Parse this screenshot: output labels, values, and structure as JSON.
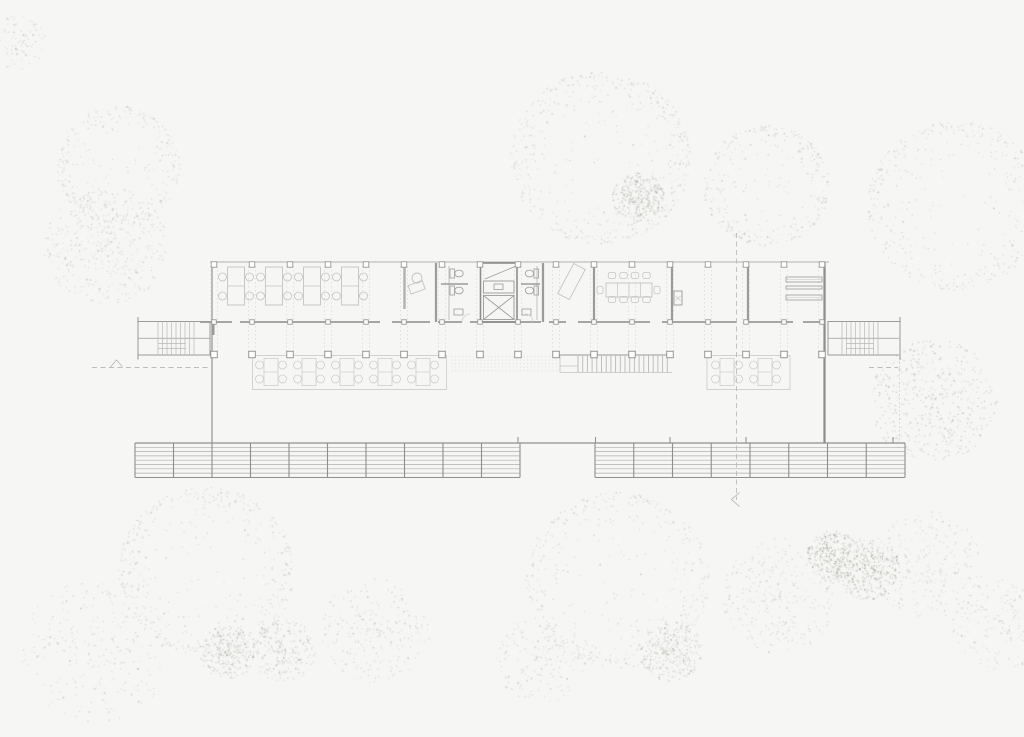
{
  "meta": {
    "width": 1024,
    "height": 737,
    "description": "Architectural ground floor plan drawing of an elongated pavilion building surrounded by stippled trees; no visible text or labels"
  },
  "colors": {
    "background": "#f6f6f4",
    "slab_line": "#b2b2b0",
    "wall": "#9b9b99",
    "wall_dark": "#8d8d8b",
    "furniture": "#c3c3c1",
    "furniture_light": "#cfcfcd",
    "grid_dash": "#d6d6d4",
    "tread": "#b9b9b7",
    "band_line": "#aeaeac",
    "band_edge": "#8f8f8d",
    "section": "#bcbcba",
    "column_fill": "#ffffff",
    "dot_light": "#b9b7b4",
    "dot_mid": "#a9a7a3",
    "dot_dark": "#999791"
  },
  "plan": {
    "grid": {
      "x_start": 214,
      "spacing": 38,
      "count": 17,
      "top_y": 263,
      "wall_y": 322,
      "colonnade_y": 354.5,
      "dash_y1": 266,
      "dash_y2": 352
    },
    "slab": {
      "x1": 210,
      "x2": 829,
      "y": 262
    },
    "left_wall": {
      "x": 212,
      "y1": 262.5,
      "y2": 443
    },
    "right_wall": {
      "x": 824.5,
      "y1": 262.5,
      "y2": 443
    },
    "wall_stub": {
      "x": 213.5,
      "y1": 322,
      "y2": 335
    },
    "wall_segments": [
      [
        200,
        232
      ],
      [
        240,
        380
      ],
      [
        392,
        430
      ],
      [
        438,
        462
      ],
      [
        470,
        541
      ],
      [
        549,
        566
      ],
      [
        578,
        650
      ],
      [
        662,
        737
      ],
      [
        749,
        793
      ],
      [
        803,
        825
      ]
    ],
    "interior_walls": [
      436,
      543,
      594,
      672,
      748
    ],
    "partition": {
      "x": 404.5,
      "y1": 263,
      "y2": 309
    },
    "office_desks": {
      "centers": [
        236,
        274,
        312,
        350
      ],
      "top": 267,
      "w": 17,
      "h": 38,
      "chair_r": 4,
      "chair_dx": 13.5,
      "chair_dy": [
        10,
        29
      ]
    },
    "reception": {
      "chair": {
        "cx": 417,
        "cy": 278,
        "r": 5
      },
      "desk": {
        "x": 409,
        "y": 283,
        "w": 15,
        "h": 9,
        "rot": -20
      }
    },
    "bath_left": {
      "plumb_x": 449,
      "stall": [
        441,
        468,
        284
      ],
      "toilets": [
        [
          450,
          269
        ],
        [
          450,
          286
        ]
      ],
      "sink": [
        454,
        309,
        9,
        6
      ],
      "door": "M 462 322 A 8 8 0 0 1 470 314"
    },
    "bath_right": {
      "plumb_x": 537,
      "stall": [
        521,
        540,
        284
      ],
      "toilets": [
        [
          534,
          269
        ],
        [
          534,
          286
        ]
      ],
      "sink": [
        522,
        309,
        9,
        6
      ],
      "door": "M 533 322 A 8 8 0 0 0 525 314"
    },
    "elevator": {
      "x": 480.5,
      "y": 263,
      "w": 36.5,
      "h": 59,
      "machine": [
        483.5,
        281,
        30.5,
        12
      ],
      "inner": [
        494,
        284,
        9,
        5.5
      ],
      "shaft": [
        483.5,
        295.5,
        30.5,
        24
      ],
      "diag": [
        485,
        279,
        515,
        266.5
      ]
    },
    "lounge": {
      "cx": 571.5,
      "cy": 281.5,
      "w": 13,
      "h": 34,
      "rot": 28
    },
    "meeting": {
      "x": 606,
      "y": 283,
      "w": 46,
      "h": 14,
      "dividers": [
        617.5,
        629,
        640.5
      ],
      "chair_cx": [
        612,
        623.5,
        635,
        646.5
      ],
      "top_y": 275.5,
      "bot_y": 299.5,
      "ends": [
        [
          600,
          290
        ],
        [
          657,
          290
        ]
      ],
      "chair_w": 7.5,
      "chair_h": 6
    },
    "cabinet": {
      "x": 674,
      "y": 291,
      "w": 8,
      "h": 14
    },
    "shelves": {
      "x": 786,
      "w": 36,
      "rows": [
        [
          277,
          5
        ],
        [
          286,
          3
        ],
        [
          295,
          5
        ]
      ]
    },
    "stairs": [
      {
        "x": 138,
        "y": 321.5,
        "w": 72,
        "h": 33.5,
        "tx1": 158,
        "tx2": 198,
        "tick_x": 138,
        "land_x1": 158
      },
      {
        "x": 828,
        "y": 321.5,
        "w": 72,
        "h": 33.5,
        "tx1": 842,
        "tx2": 882,
        "tick_x": 900,
        "land_x1": 846
      }
    ],
    "terraces": [
      {
        "x": 252.5,
        "y": 355.5,
        "w": 194,
        "h": 34,
        "clusters": [
          271,
          309,
          347,
          385,
          423
        ]
      },
      {
        "x": 707,
        "y": 355.5,
        "w": 83,
        "h": 34,
        "clusters": [
          727,
          765
        ]
      }
    ],
    "hatch": {
      "x": 452,
      "y": 356,
      "w": 106,
      "h": 17,
      "step": 3.6
    },
    "center_steps": {
      "x1": 578,
      "x2": 672,
      "y1": 355,
      "y2": 372.5,
      "step": 4.7,
      "top_x1": 556,
      "notch_x": 560,
      "notch_y": 366
    },
    "band": {
      "top_y": 443,
      "bot_y": 477.5,
      "top_x1": 135,
      "top_x2": 905,
      "slats": 7,
      "slat_step": 4.3,
      "segments": [
        {
          "x1": 135,
          "x2": 520,
          "div": 38.5
        },
        {
          "x1": 595,
          "x2": 905,
          "div": 38.75
        }
      ],
      "ticks": [
        518,
        595.5,
        670,
        746,
        893
      ]
    },
    "section": {
      "left_dash": [
        92,
        367.5,
        210,
        367.5
      ],
      "left_tri": "110.5,367 116.5,360 122.5,367",
      "right_dash": [
        869,
        367.5,
        898,
        367.5
      ],
      "vline": [
        736.5,
        233,
        736.5,
        500
      ],
      "varrow": "739.5,492.5 731.5,499.5 739.5,506.5",
      "right_dotted": [
        899.5,
        322,
        899.5,
        443
      ]
    }
  },
  "vegetation": {
    "trees": [
      {
        "cx": 118,
        "cy": 165,
        "r": 62,
        "type": "ring",
        "n": 320,
        "shade": "light"
      },
      {
        "cx": 105,
        "cy": 245,
        "r": 62,
        "type": "blob",
        "n": 430,
        "shade": "light"
      },
      {
        "cx": 18,
        "cy": 42,
        "r": 28,
        "type": "blob",
        "n": 80,
        "shade": "light"
      },
      {
        "cx": 600,
        "cy": 157,
        "r": 90,
        "type": "ring",
        "n": 470,
        "shade": "light"
      },
      {
        "cx": 638,
        "cy": 197,
        "r": 26,
        "type": "blob",
        "n": 330,
        "shade": "mid"
      },
      {
        "cx": 766,
        "cy": 185,
        "r": 63,
        "type": "ring",
        "n": 330,
        "shade": "light"
      },
      {
        "cx": 955,
        "cy": 205,
        "r": 88,
        "type": "ring",
        "n": 430,
        "shade": "light"
      },
      {
        "cx": 206,
        "cy": 571,
        "r": 88,
        "type": "ring",
        "n": 470,
        "shade": "light"
      },
      {
        "cx": 95,
        "cy": 650,
        "r": 75,
        "type": "blob",
        "n": 260,
        "shade": "light"
      },
      {
        "cx": 227,
        "cy": 652,
        "r": 28,
        "type": "blob",
        "n": 260,
        "shade": "mid"
      },
      {
        "cx": 282,
        "cy": 650,
        "r": 33,
        "type": "blob",
        "n": 230,
        "shade": "mid"
      },
      {
        "cx": 375,
        "cy": 630,
        "r": 55,
        "type": "blob",
        "n": 240,
        "shade": "light"
      },
      {
        "cx": 617,
        "cy": 580,
        "r": 92,
        "type": "ring",
        "n": 430,
        "shade": "light"
      },
      {
        "cx": 670,
        "cy": 650,
        "r": 32,
        "type": "blob",
        "n": 280,
        "shade": "mid"
      },
      {
        "cx": 780,
        "cy": 595,
        "r": 60,
        "type": "blob",
        "n": 300,
        "shade": "light"
      },
      {
        "cx": 832,
        "cy": 555,
        "r": 26,
        "type": "blob",
        "n": 300,
        "shade": "dark"
      },
      {
        "cx": 868,
        "cy": 568,
        "r": 33,
        "type": "blob",
        "n": 360,
        "shade": "dark"
      },
      {
        "cx": 933,
        "cy": 400,
        "r": 64,
        "type": "blob",
        "n": 470,
        "shade": "mid"
      },
      {
        "cx": 928,
        "cy": 565,
        "r": 56,
        "type": "blob",
        "n": 250,
        "shade": "light"
      },
      {
        "cx": 1000,
        "cy": 625,
        "r": 48,
        "type": "blob",
        "n": 180,
        "shade": "light"
      },
      {
        "cx": 540,
        "cy": 660,
        "r": 45,
        "type": "blob",
        "n": 170,
        "shade": "light"
      }
    ]
  }
}
